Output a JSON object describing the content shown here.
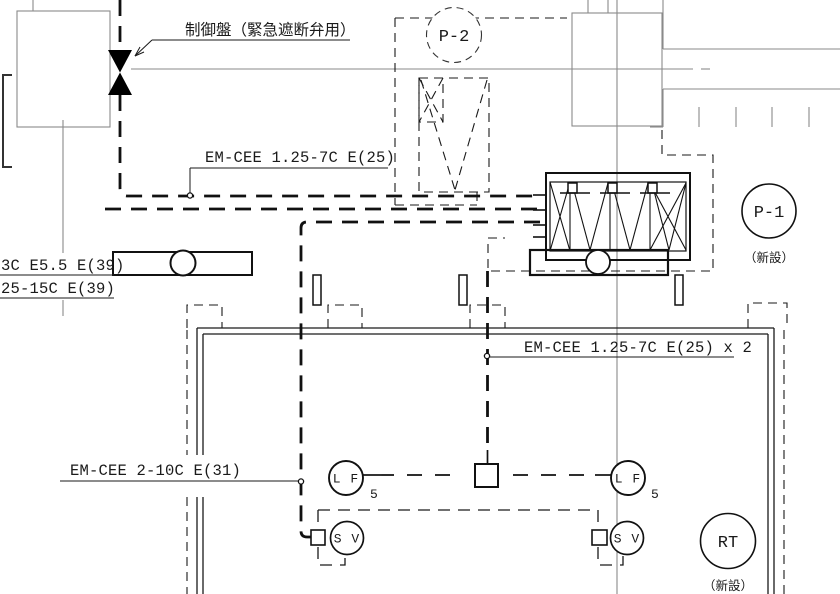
{
  "drawing": {
    "labels": {
      "control_panel": "制御盤（緊急遮断弁用）",
      "cable_7c": "EM-CEE 1.25-7C E(25)",
      "cable_7c_x2": "EM-CEE 1.25-7C E(25) x 2",
      "cable_3c": "3C E5.5 E(39)",
      "cable_25_15c": "25-15C E(39)",
      "cable_2_10c": "EM-CEE 2-10C E(31)"
    },
    "tags": {
      "p2": "P-2",
      "p1": "P-1",
      "rt": "RT",
      "lf": "L F",
      "sv": "S V",
      "lf_sub": "5",
      "new_note": "（新設）"
    },
    "colors": {
      "line": "#1a1a1a",
      "structure": "#8a8a8a",
      "background": "#ffffff"
    }
  }
}
